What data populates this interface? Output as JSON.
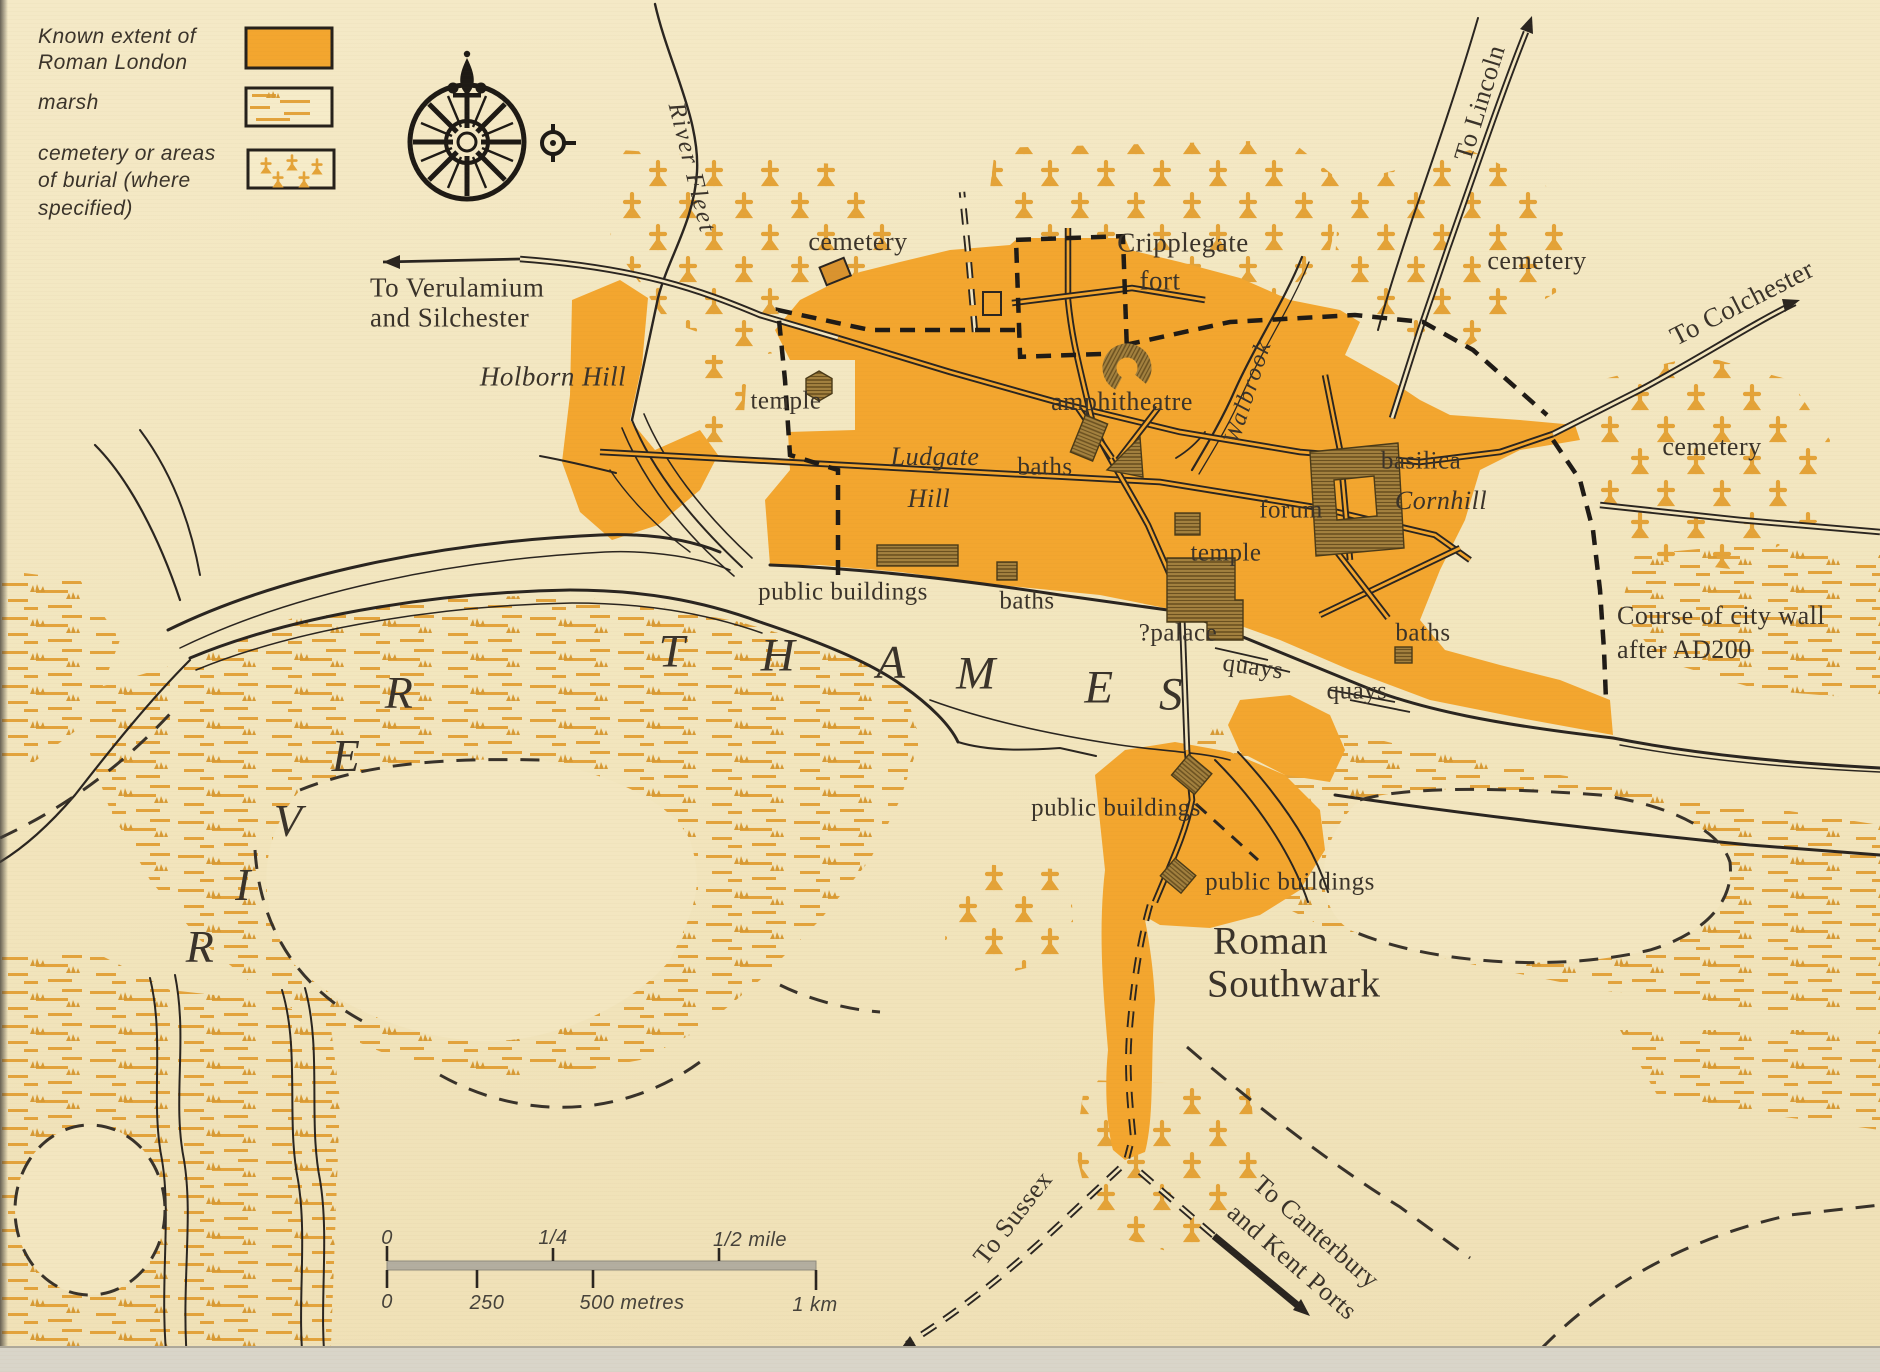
{
  "legend": {
    "items": [
      {
        "label": "Known extent of Roman London",
        "swatch": "roman-extent-swatch"
      },
      {
        "label": "marsh",
        "swatch": "marsh-swatch"
      },
      {
        "label": "cemetery or areas of burial (where specified)",
        "swatch": "cemetery-swatch"
      }
    ]
  },
  "map_labels": {
    "to_verulamium_1": "To Verulamium",
    "to_verulamium_2": "and Silchester",
    "river_fleet": "River Fleet",
    "holborn_hill": "Holborn Hill",
    "cemetery_nw": "cemetery",
    "cripplegate": "Cripplegate",
    "fort": "fort",
    "to_lincoln": "To Lincoln",
    "cemetery_n": "cemetery",
    "to_colchester": "To Colchester",
    "cemetery_e": "cemetery",
    "temple_w": "temple",
    "amphitheatre": "amphitheatre",
    "walbrook": "Walbrook",
    "baths_w": "baths",
    "ludgate": "Ludgate",
    "ludgate_hill": "Hill",
    "basilica": "basilica",
    "cornhill": "Cornhill",
    "forum": "forum",
    "temple_c": "temple",
    "public_buildings_n": "public buildings",
    "baths_waterfront": "baths",
    "palace": "?palace",
    "quays_w": "quays",
    "quays_e": "quays",
    "baths_se": "baths",
    "city_wall_1": "Course of city wall",
    "city_wall_2": "after AD200",
    "public_buildings_s1": "public buildings",
    "public_buildings_s2": "public buildings",
    "roman": "Roman",
    "southwark": "Southwark",
    "to_sussex": "To Sussex",
    "to_canterbury_1": "To Canterbury",
    "to_canterbury_2": "and Kent Ports"
  },
  "river": {
    "letters": [
      "R",
      "I",
      "V",
      "E",
      "R",
      "T",
      "H",
      "A",
      "M",
      "E",
      "S"
    ]
  },
  "scale": {
    "miles": [
      "0",
      "1/4",
      "1/2 mile"
    ],
    "metres": [
      "0",
      "250",
      "500 metres",
      "1 km"
    ]
  },
  "colors": {
    "background": "#f3e6c0",
    "roman_extent": "#f3a62f",
    "marsh_orange": "#e3a33c",
    "cemetery_cross": "#e4a338",
    "building_brown": "#a3813f",
    "ink": "#2a2520",
    "text": "#3a332a",
    "scale_bar": "#b3aea0"
  }
}
